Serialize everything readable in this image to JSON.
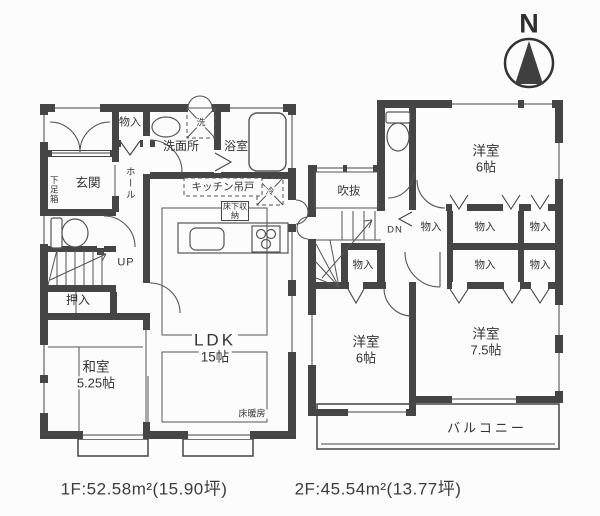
{
  "colors": {
    "wall": "#454545",
    "line": "#555555",
    "text": "#333333",
    "background": "#fcfcfc"
  },
  "compass": {
    "label": "N"
  },
  "floor1": {
    "closet": "物入",
    "washroom": "洗面所",
    "washer_mark": "洗",
    "bath": "浴室",
    "entrance": "玄関",
    "shoe_cabinet": "下足箱",
    "hall": "ホール",
    "kitchen_cupboard": "キッチン吊戸",
    "underfloor_storage": "床下収納",
    "fridge_mark": "冷",
    "stairs_up": "UP",
    "oshiire": "押入",
    "japanese_room": "和室",
    "japanese_room_size": "5.25帖",
    "ldk": "LDK",
    "ldk_size": "15帖",
    "floor_heating": "床暖房",
    "caption": "1F:52.58m²(15.90坪)"
  },
  "floor2": {
    "western_room_top": "洋室",
    "western_room_top_size": "6帖",
    "void": "吹抜",
    "stairs_down": "DN",
    "closets": [
      "物入",
      "物入",
      "物入",
      "物入",
      "物入",
      "物入"
    ],
    "western_room_left": "洋室",
    "western_room_left_size": "6帖",
    "western_room_right": "洋室",
    "western_room_right_size": "7.5帖",
    "balcony": "バルコニー",
    "caption": "2F:45.54m²(13.77坪)"
  }
}
